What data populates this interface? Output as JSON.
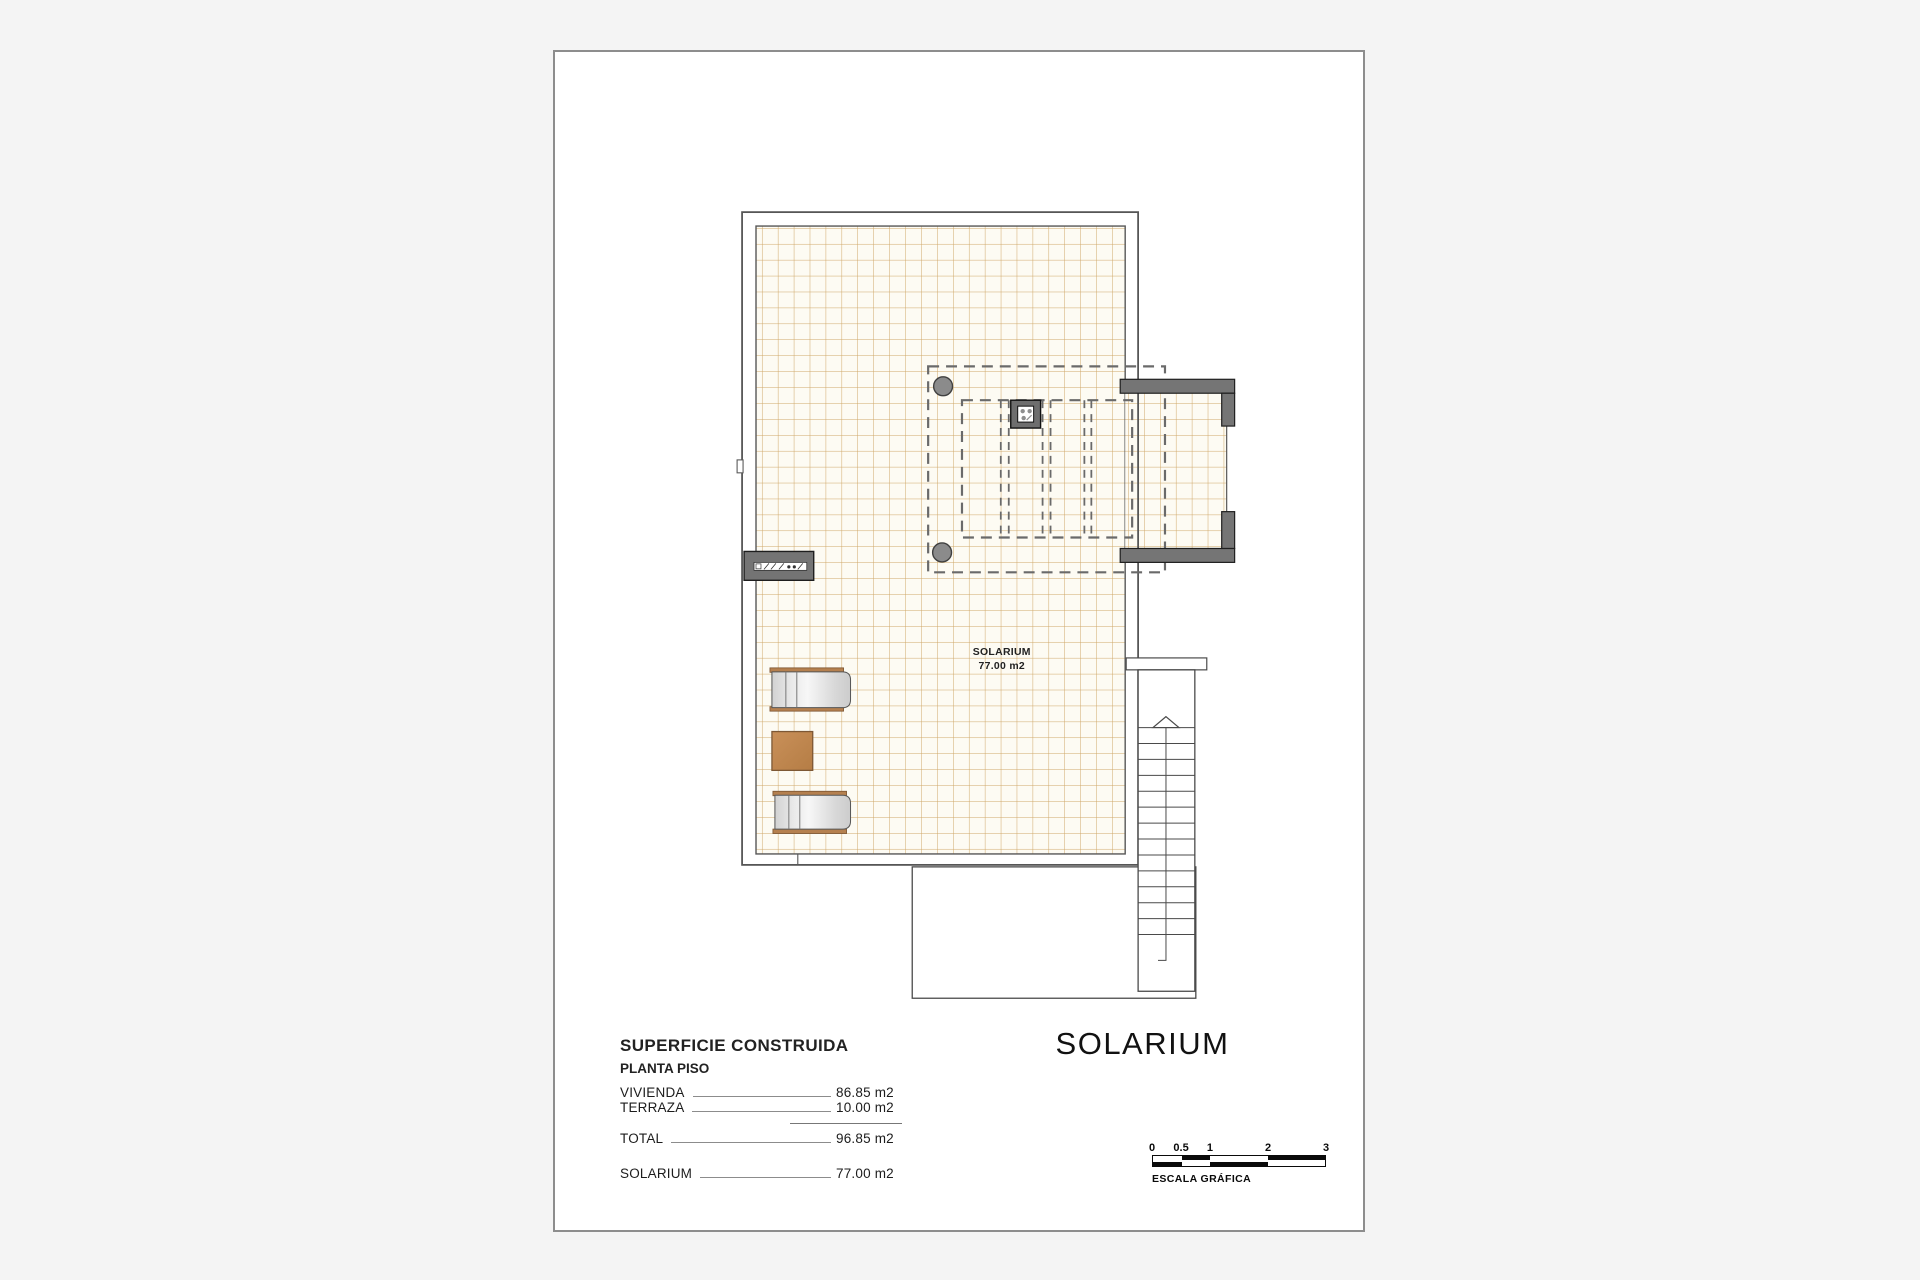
{
  "drawing_title": "SOLARIUM",
  "plan": {
    "room": {
      "name": "SOLARIUM",
      "area": "77.00 m2"
    },
    "elements": [
      "tiled-floor",
      "pergola-dashed-outline",
      "roof-vent-chimney",
      "pergola-posts",
      "recessed-bay-walls",
      "stairs-up",
      "sun-lounger",
      "sun-lounger",
      "side-table",
      "wall-ac-unit"
    ]
  },
  "legend": {
    "title": "SUPERFICIE CONSTRUIDA",
    "subtitle": "PLANTA PISO",
    "rows": [
      {
        "label": "VIVIENDA",
        "value": "86.85 m2"
      },
      {
        "label": "TERRAZA",
        "value": "10.00 m2"
      },
      {
        "label": "TOTAL",
        "value": "96.85 m2"
      },
      {
        "label": "SOLARIUM",
        "value": "77.00 m2"
      }
    ]
  },
  "scalebar": {
    "ticks": [
      "0",
      "0.5",
      "1",
      "2",
      "3"
    ],
    "caption": "ESCALA GRÁFICA"
  },
  "colors": {
    "canvas_bg": "#f4f4f4",
    "page_bg": "#ffffff",
    "page_border": "#8d8d8d",
    "tile_bg": "#fdfbf3",
    "tile_line": "#cfa768",
    "wall_line": "#565656",
    "wall_fill": "#757575",
    "dash_line": "#6a6a6a",
    "lounger_wood": "#b5804f",
    "table_fill": "#c18a52",
    "text": "#1c1c1c"
  }
}
